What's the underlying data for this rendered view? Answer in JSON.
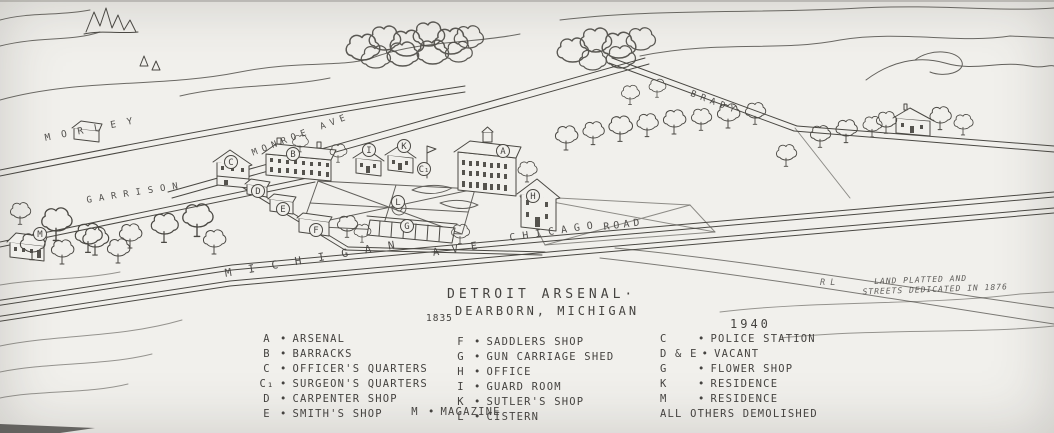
{
  "colors": {
    "paper": "#f1f0ec",
    "ink": "#454340"
  },
  "title": {
    "line1": "DETROIT ARSENAL·",
    "line2": "DEARBORN, MICHIGAN",
    "year_left": "1835",
    "year_right": "1940"
  },
  "plat_note": {
    "initials": "R L",
    "line1": "LAND PLATTED AND",
    "line2": "STREETS DEDICATED IN 1876"
  },
  "streets": {
    "michigan": "MICHIGAN",
    "ave": "AVE",
    "chicago": "CHICAGO",
    "road": "ROAD",
    "monroe": "MONROE AVE",
    "morley": "MORLEY",
    "garrison": "GARRISON",
    "brady": "BRADY"
  },
  "legend": {
    "bullet": "•",
    "col_1835": [
      {
        "key": "A",
        "label": "ARSENAL"
      },
      {
        "key": "B",
        "label": "BARRACKS"
      },
      {
        "key": "C",
        "label": "OFFICER'S QUARTERS"
      },
      {
        "key": "C₁",
        "label": "SURGEON'S QUARTERS"
      },
      {
        "key": "D",
        "label": "CARPENTER SHOP"
      },
      {
        "key": "E",
        "label": "SMITH'S SHOP"
      }
    ],
    "col_shops": [
      {
        "key": "F",
        "label": "SADDLERS SHOP"
      },
      {
        "key": "G",
        "label": "GUN CARRIAGE SHED"
      },
      {
        "key": "H",
        "label": "OFFICE"
      },
      {
        "key": "I",
        "label": "GUARD ROOM"
      },
      {
        "key": "K",
        "label": "SUTLER'S SHOP"
      },
      {
        "key": "L",
        "label": "CISTERN"
      }
    ],
    "magazine": {
      "key": "M",
      "label": "MAGAZINE"
    },
    "col_1940": [
      {
        "key": "C",
        "label": "POLICE STATION"
      },
      {
        "key": "D & E",
        "label": "VACANT"
      },
      {
        "key": "G",
        "label": "FLOWER SHOP"
      },
      {
        "key": "K",
        "label": "RESIDENCE"
      },
      {
        "key": "M",
        "label": "RESIDENCE"
      }
    ],
    "col_1940_footer": "ALL OTHERS DEMOLISHED"
  },
  "markers": {
    "arsenal": "A",
    "barracks": "B",
    "officers_quarters": "C",
    "surgeons_quarters": "C₁",
    "carpenter_shop": "D",
    "smiths_shop": "E",
    "saddlers_shop": "F",
    "gun_carriage_shed": "G",
    "office": "H",
    "guard_room": "I",
    "sutlers_shop": "K",
    "cistern": "L",
    "magazine": "M"
  }
}
